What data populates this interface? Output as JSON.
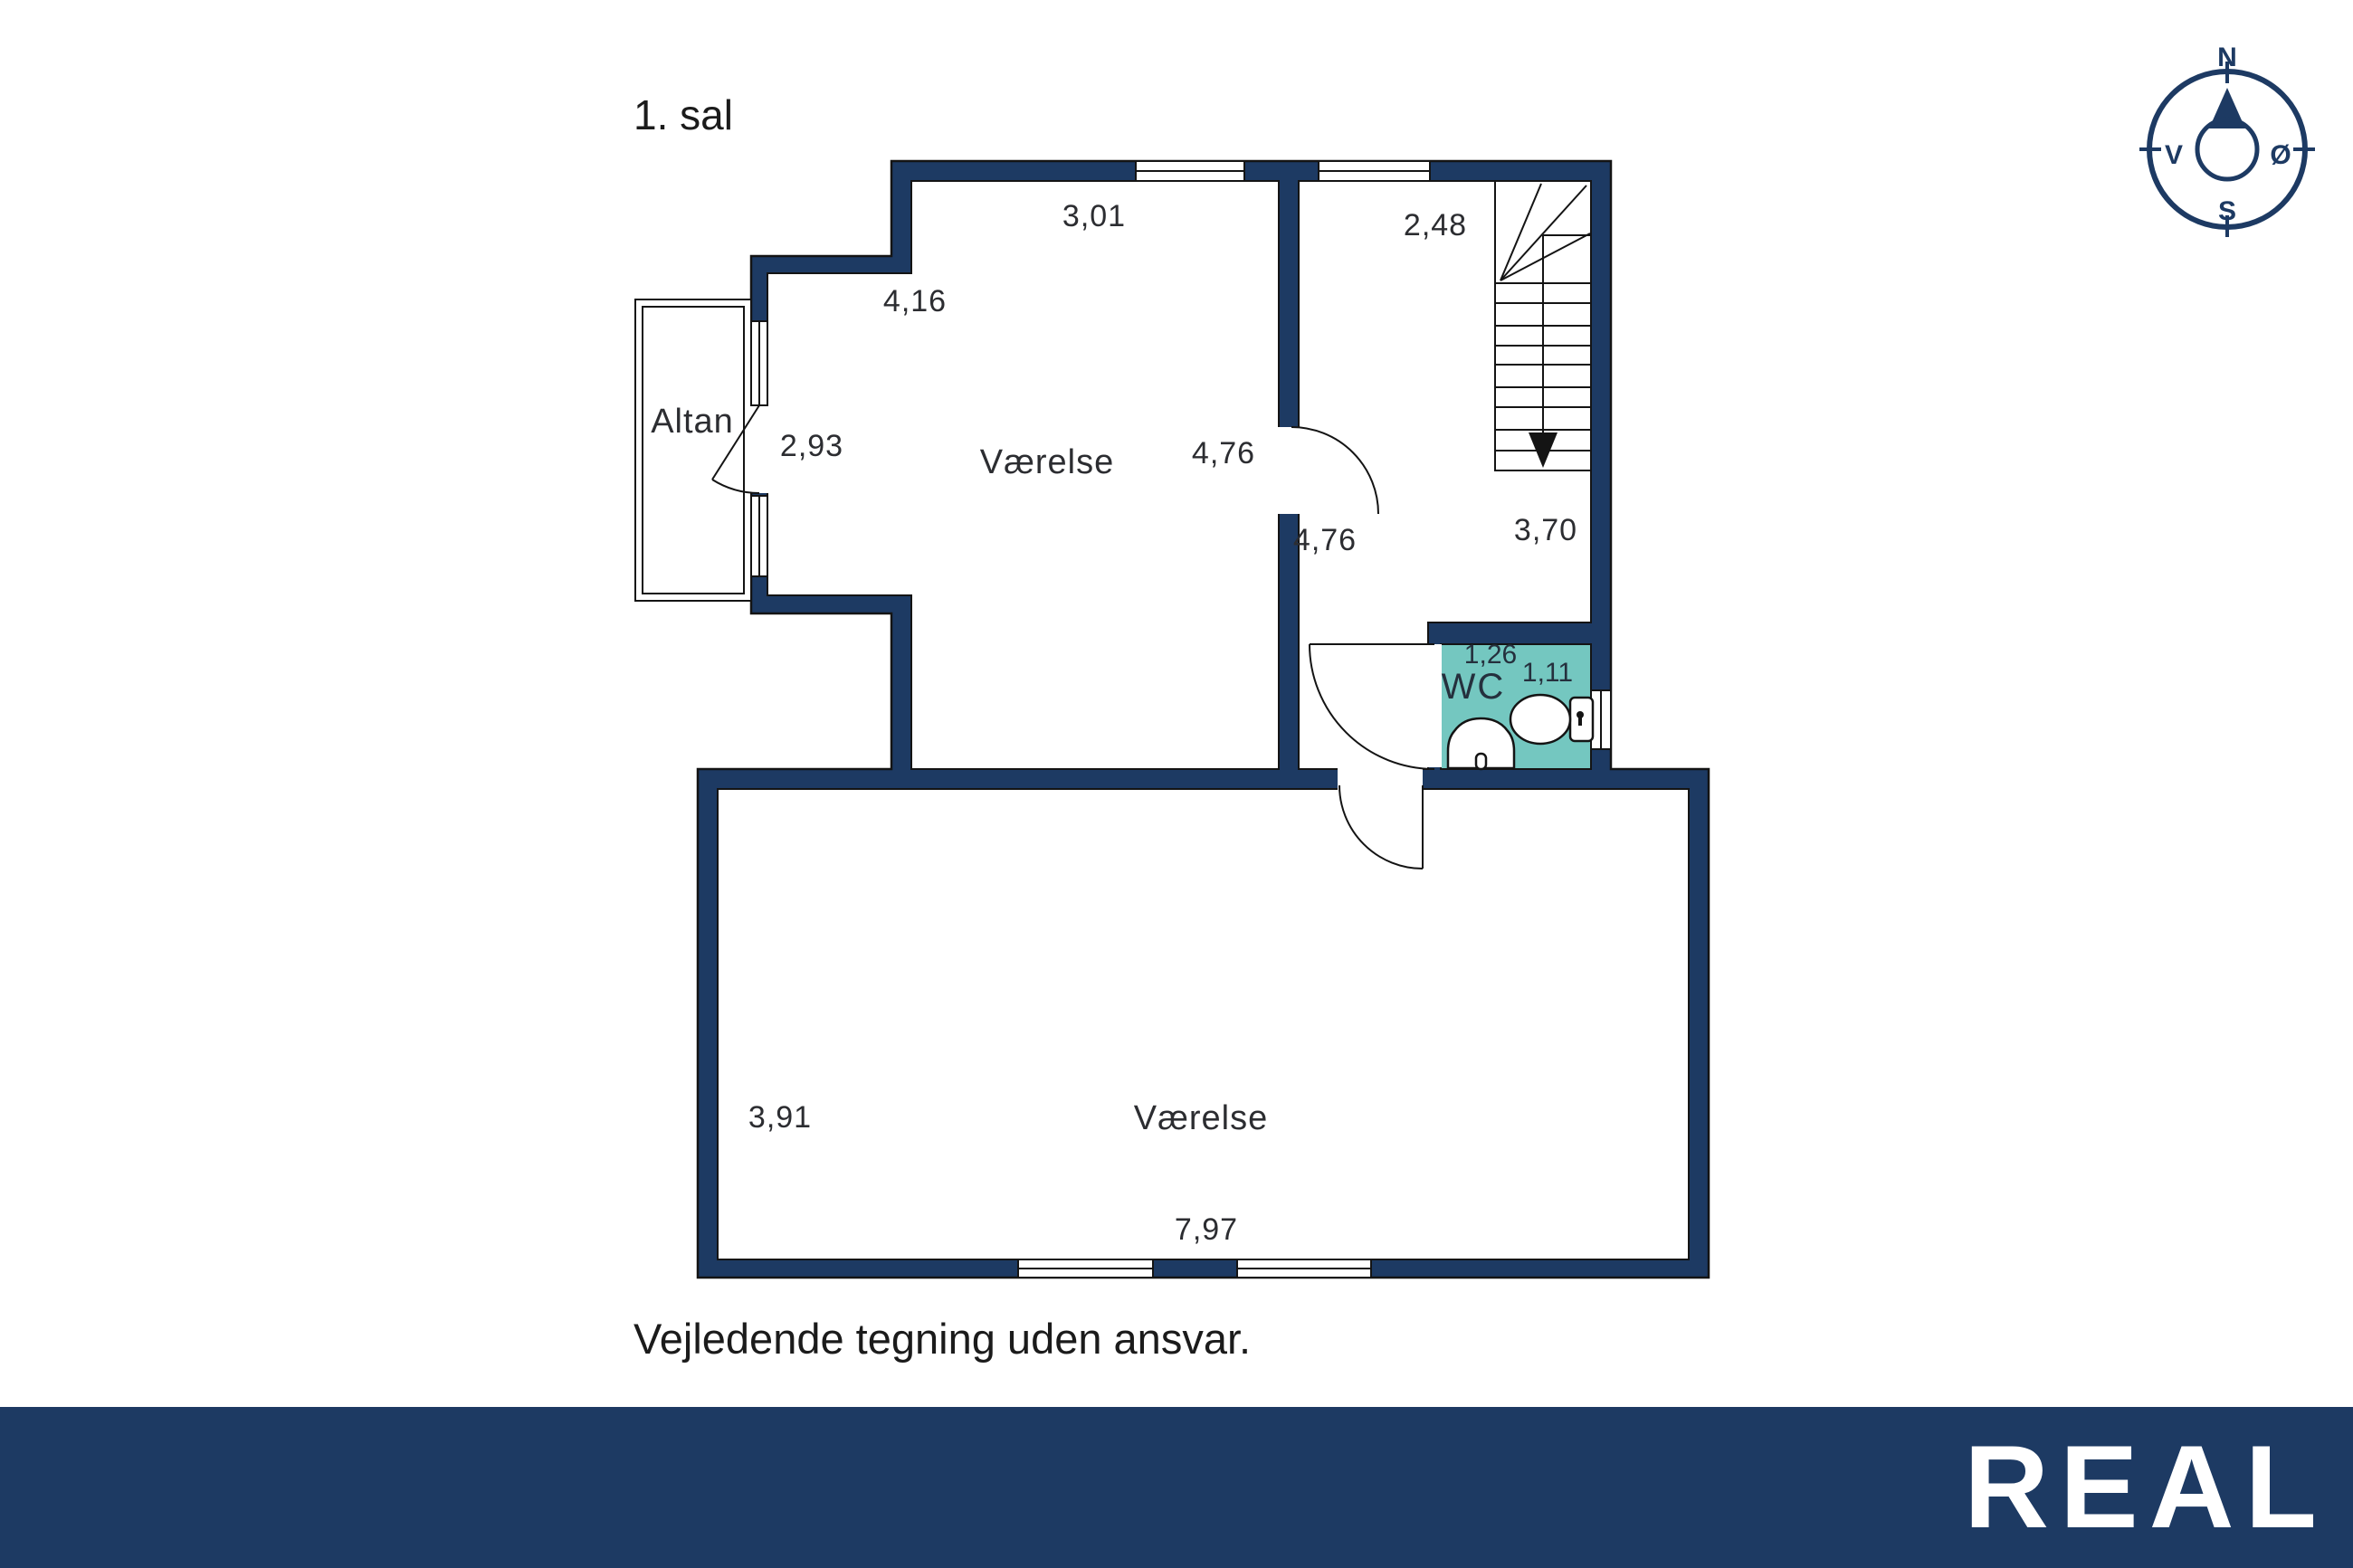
{
  "title": "1. sal",
  "footer": {
    "disclaimer": "Vejledende tegning uden ansvar."
  },
  "brand": {
    "logo": "REAL"
  },
  "colors": {
    "wall_navy": "#1d3a63",
    "wc_teal": "#74c7c0",
    "outline": "#141414",
    "logo_bar": "#1d3a63",
    "text": "#2c2d31"
  },
  "compass": {
    "north": "N",
    "west": "V",
    "east": "Ø",
    "south": "S"
  },
  "rooms": {
    "upper": "Værelse",
    "lower": "Værelse",
    "wc": "WC",
    "balcony": "Altan"
  },
  "dimensions": {
    "upper_room_top": "3,01",
    "hall_top": "2,48",
    "upper_room_west": "4,16",
    "balcony_side": "2,93",
    "upper_room_depth": "4,76",
    "hall_west": "4,76",
    "hall_east": "3,70",
    "wc_width": "1,26",
    "wc_depth": "1,11",
    "lower_room_west": "3,91",
    "lower_room_bottom": "7,97"
  }
}
